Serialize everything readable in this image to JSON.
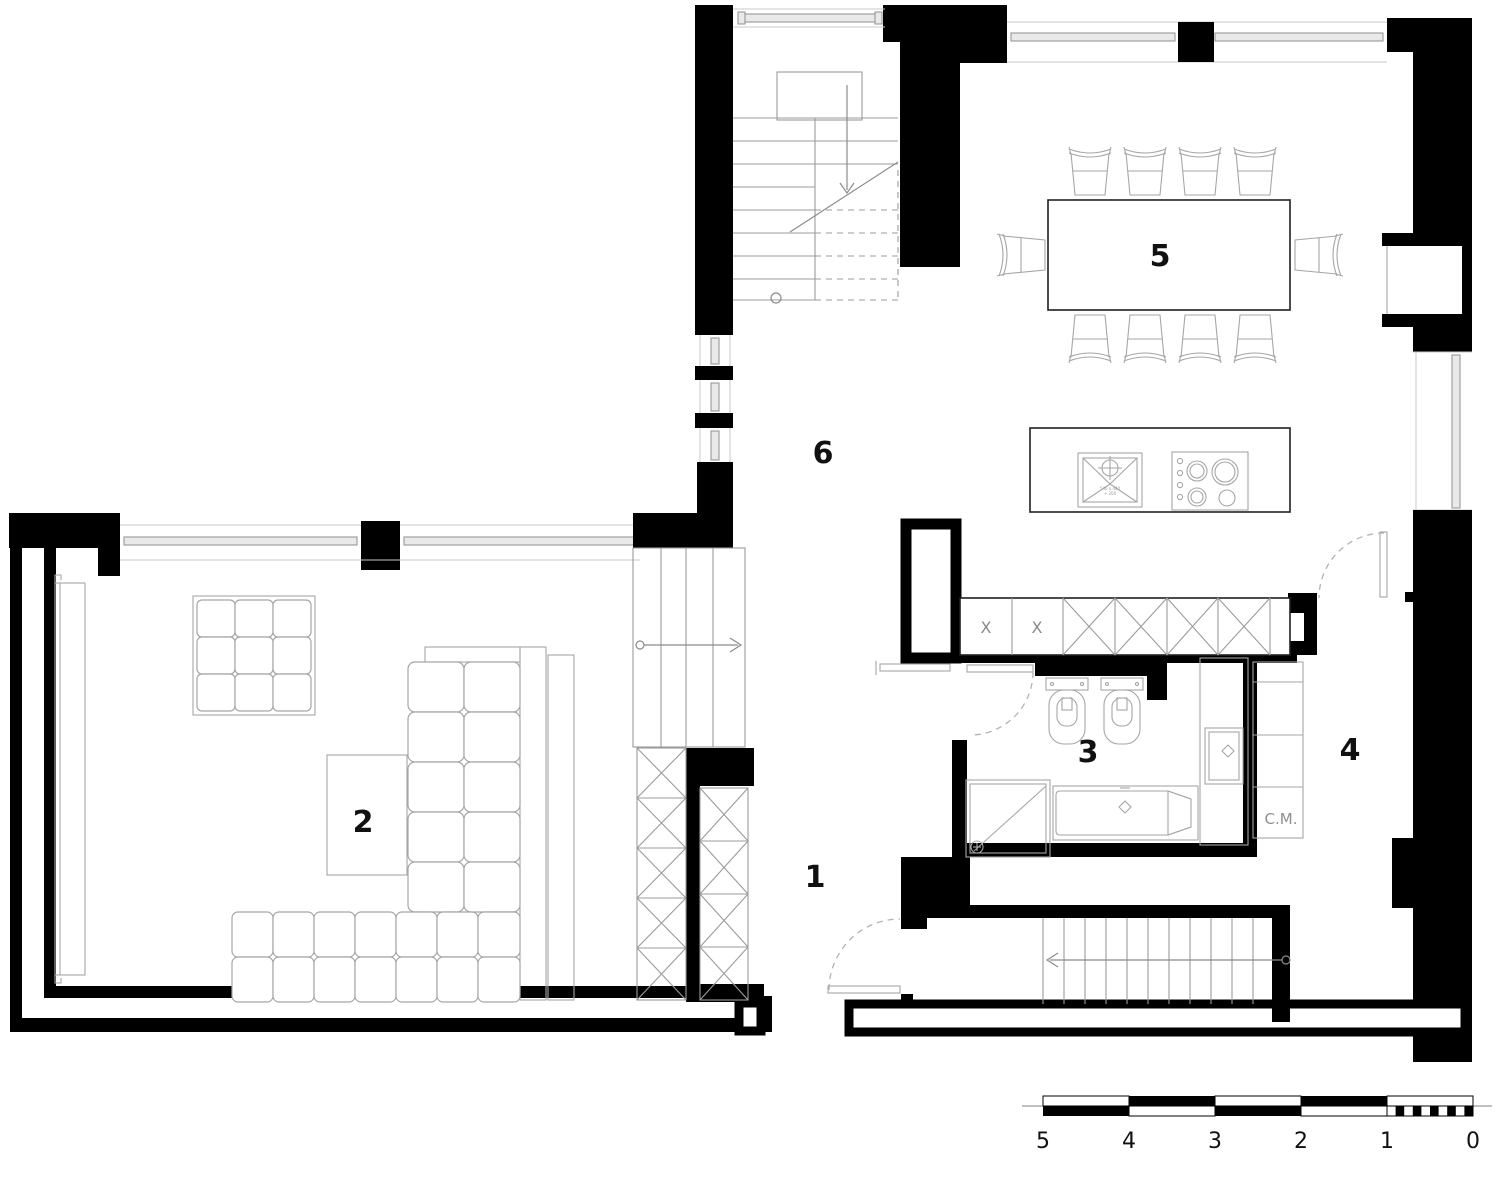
{
  "title": "Apartment floor plan",
  "rooms": [
    {
      "id": "1",
      "label": "1"
    },
    {
      "id": "2",
      "label": "2"
    },
    {
      "id": "3",
      "label": "3"
    },
    {
      "id": "4",
      "label": "4"
    },
    {
      "id": "5",
      "label": "5"
    },
    {
      "id": "6",
      "label": "6"
    }
  ],
  "annotations": {
    "cm_label": "C.M.",
    "cabinet_mark_1": "X",
    "cabinet_mark_2": "X",
    "sink_label_line1": "540 x 440",
    "sink_label_line2": "+ 200"
  },
  "scale_bar": {
    "labels": [
      "5",
      "4",
      "3",
      "2",
      "1",
      "0"
    ]
  },
  "colors": {
    "wall": "#000000",
    "furniture_line": "#a6a6a6",
    "light_line": "#c9c9c9",
    "dash_line": "#b3b3b3",
    "label": "#111111",
    "muted_label": "#8f8f8f",
    "paper": "#ffffff"
  }
}
